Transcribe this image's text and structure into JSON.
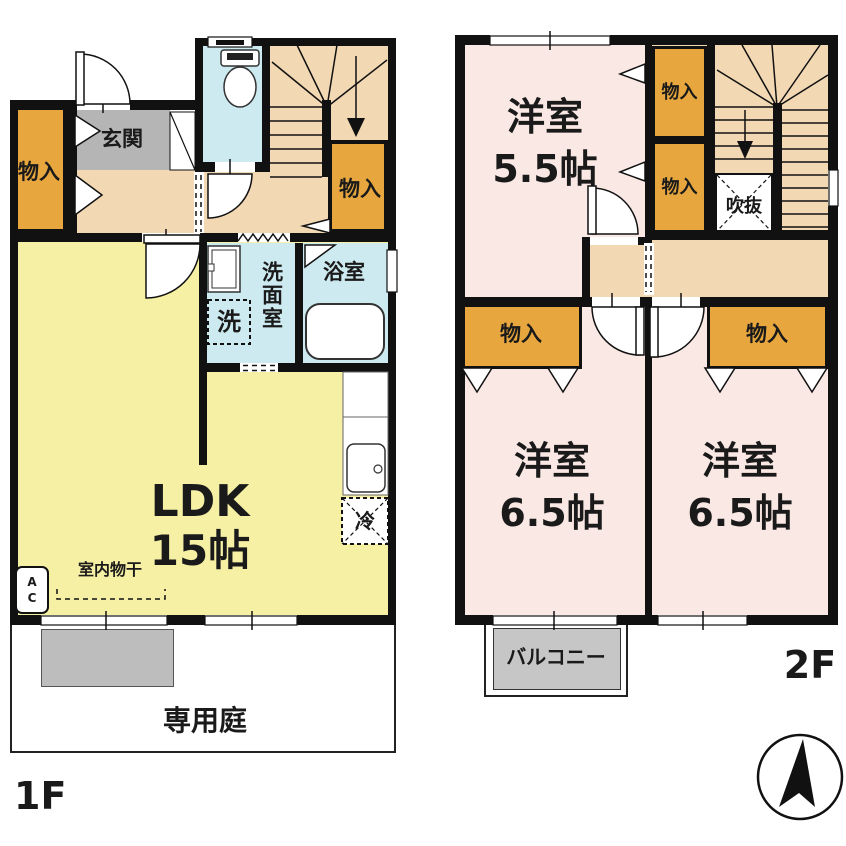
{
  "floor1": {
    "floor_label": "1F",
    "entrance": "玄関",
    "storage": "物入",
    "washroom": "洗面室",
    "bathroom": "浴室",
    "washer": "洗",
    "refrigerator": "冷",
    "ldk_name": "LDK",
    "ldk_size": "15帖",
    "indoor_drying": "室内物干",
    "ac_unit": "AC",
    "private_garden": "専用庭"
  },
  "floor2": {
    "floor_label": "2F",
    "bedroom_55_name": "洋室",
    "bedroom_55_size": "5.5帖",
    "storage": "物入",
    "atrium_void": "吹抜",
    "bedroom_65_name": "洋室",
    "bedroom_65_size": "6.5帖",
    "balcony": "バルコニー"
  },
  "colors": {
    "wall": "#111111",
    "ldk_yellow": "#F6F0A4",
    "bedroom_pink": "#FAE8E4",
    "storage_orange": "#E7A73E",
    "hallway_tan": "#F3D8B4",
    "wet_area_blue": "#CDEAF0",
    "entrance_gray": "#B5B5B5",
    "balcony_gray": "#C6C6C6"
  }
}
